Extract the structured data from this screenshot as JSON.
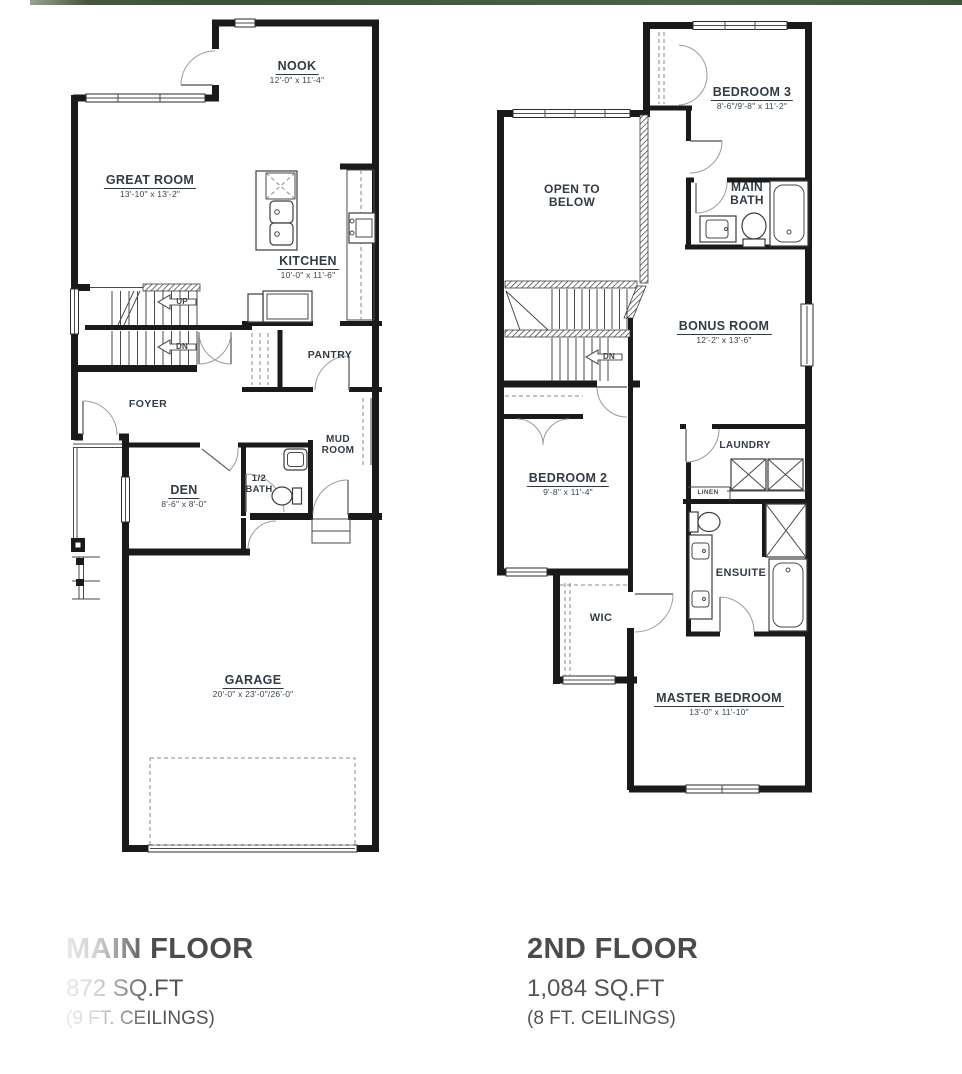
{
  "page": {
    "accent_strip_color": "#3c523a"
  },
  "plans": {
    "main": {
      "rooms": {
        "nook": {
          "name": "NOOK",
          "dims": "12'-0\" x 11'-4\""
        },
        "great_room": {
          "name": "GREAT ROOM",
          "dims": "13'-10\" x 13'-2\""
        },
        "kitchen": {
          "name": "KITCHEN",
          "dims": "10'-0\" x 11'-6\""
        },
        "den": {
          "name": "DEN",
          "dims": "8'-6\" x 8'-0\""
        },
        "garage": {
          "name": "GARAGE",
          "dims": "20'-0\" x 23'-0\"/26'-0\""
        },
        "pantry": {
          "name": "PANTRY"
        },
        "foyer": {
          "name": "FOYER"
        },
        "mud_room": {
          "line1": "MUD",
          "line2": "ROOM"
        },
        "half_bath": {
          "line1": "1/2",
          "line2": "BATH"
        }
      },
      "stair_labels": {
        "up": "UP",
        "down": "DN"
      }
    },
    "second": {
      "rooms": {
        "bedroom3": {
          "name": "BEDROOM 3",
          "dims": "8'-6\"/9'-8\" x 11'-2\""
        },
        "open_below": {
          "line1": "OPEN TO",
          "line2": "BELOW"
        },
        "main_bath": {
          "line1": "MAIN",
          "line2": "BATH"
        },
        "bonus": {
          "name": "BONUS ROOM",
          "dims": "12'-2\" x 13'-6\""
        },
        "bedroom2": {
          "name": "BEDROOM 2",
          "dims": "9'-8\" x 11'-4\""
        },
        "laundry": {
          "name": "LAUNDRY"
        },
        "linen": {
          "name": "LINEN"
        },
        "ensuite": {
          "name": "ENSUITE"
        },
        "wic": {
          "name": "WIC"
        },
        "master": {
          "name": "MASTER BEDROOM",
          "dims": "13'-0\" x 11'-10\""
        }
      },
      "stair_labels": {
        "down": "DN"
      }
    }
  },
  "footer": {
    "main": {
      "title": "MAIN FLOOR",
      "area": "872 SQ.FT",
      "ceilings": "(9 FT. CEILINGS)"
    },
    "second": {
      "title": "2ND FLOOR",
      "area": "1,084 SQ.FT",
      "ceilings": "(8 FT. CEILINGS)"
    }
  }
}
